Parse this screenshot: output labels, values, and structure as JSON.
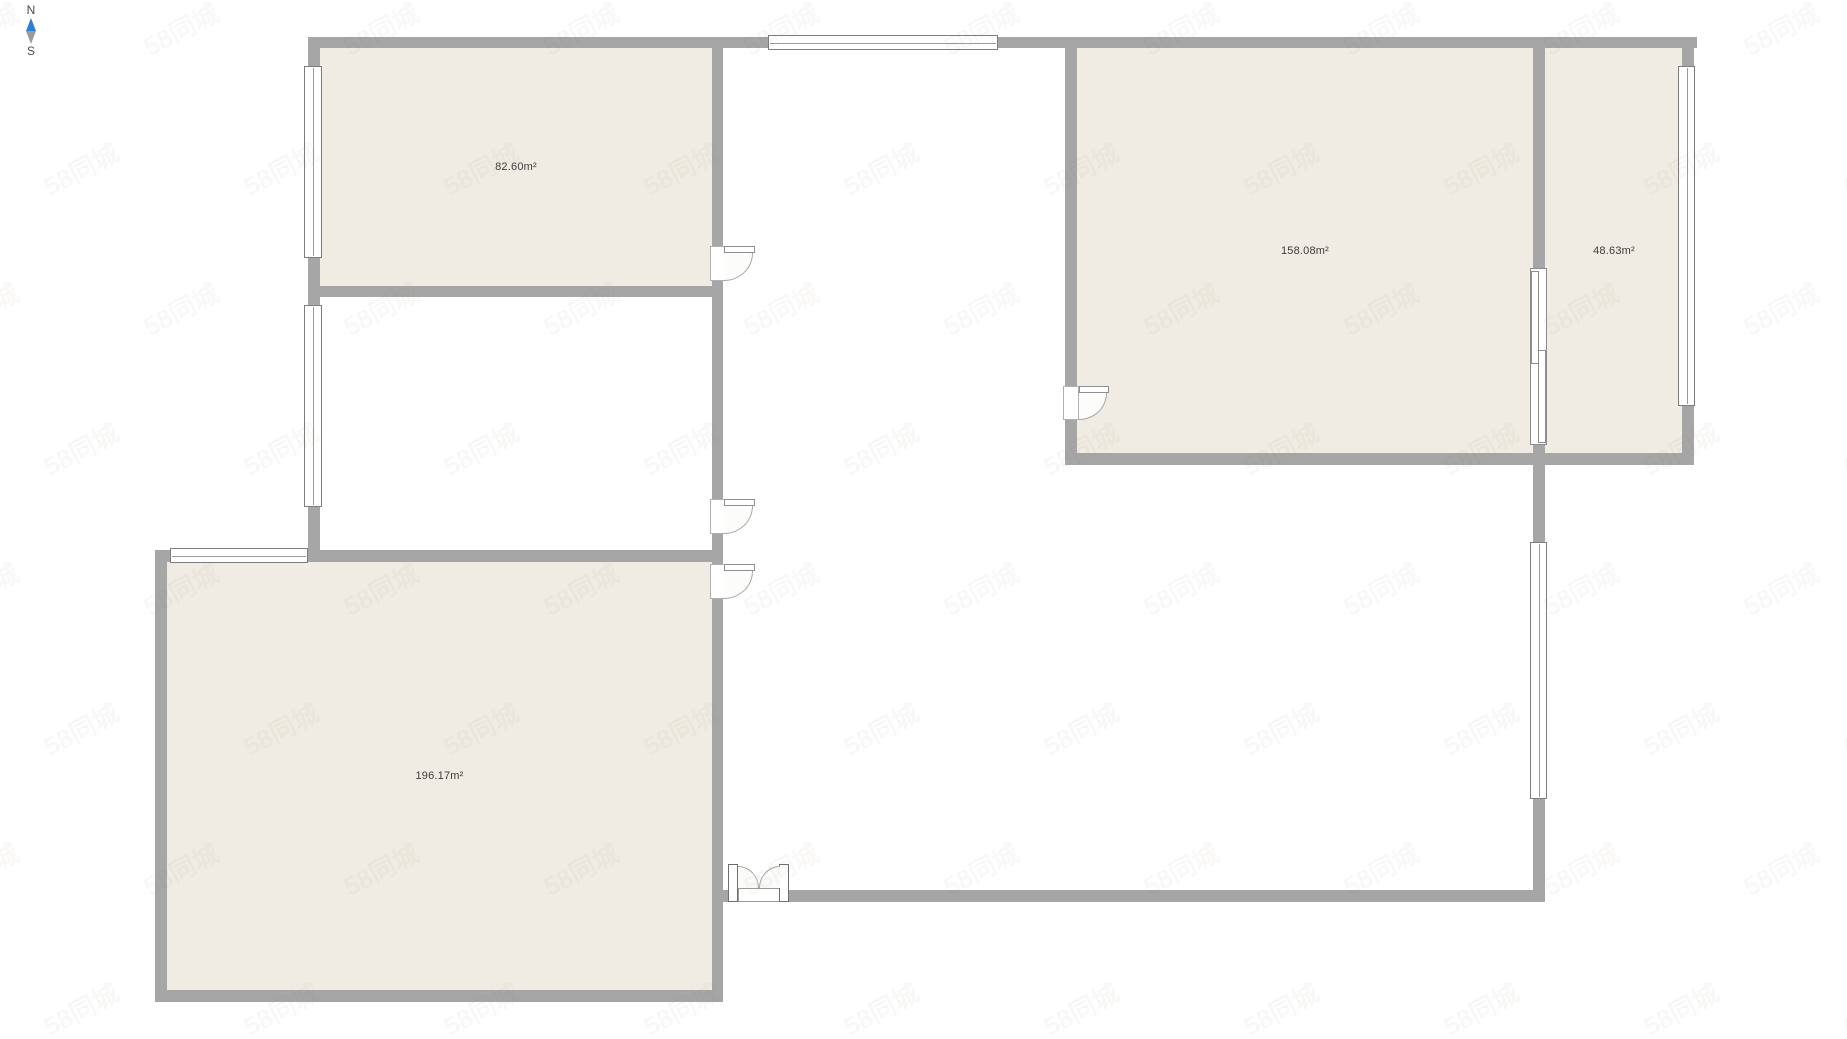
{
  "compass": {
    "north_label": "N",
    "south_label": "S"
  },
  "watermark_text": "58同城",
  "rooms": [
    {
      "name": "top-left-room",
      "area_label": "82.60m²"
    },
    {
      "name": "bottom-left-room",
      "area_label": "196.17m²"
    },
    {
      "name": "right-large-room",
      "area_label": "158.08m²"
    },
    {
      "name": "right-small-room",
      "area_label": "48.63m²"
    }
  ],
  "colors": {
    "wall": "#a6a6a6",
    "room_fill": "#f0ece3",
    "compass_north_arrow": "#2f80d0",
    "compass_south_arrow": "#9b9b9b",
    "label_text": "#3c3c3c"
  }
}
